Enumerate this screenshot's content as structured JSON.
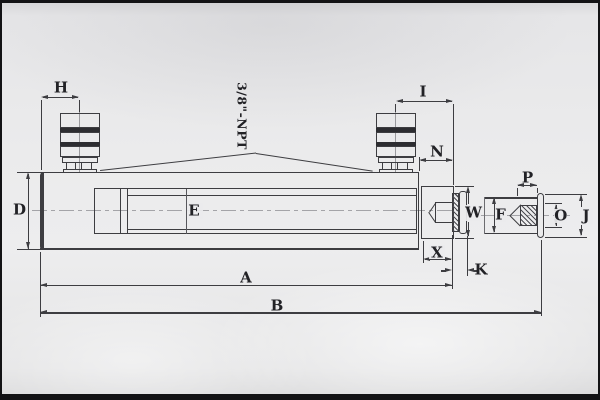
{
  "sheet": {
    "annotation_npt": "3/8\"-NPT",
    "labels": {
      "A": "A",
      "B": "B",
      "D": "D",
      "E": "E",
      "F": "F",
      "H": "H",
      "I": "I",
      "J": "J",
      "K": "K",
      "N": "N",
      "O": "O",
      "P": "P",
      "W": "W",
      "X": "X"
    },
    "colors": {
      "paper": "#ebebec",
      "ink": "#3d3d41",
      "frame": "#131315"
    }
  }
}
